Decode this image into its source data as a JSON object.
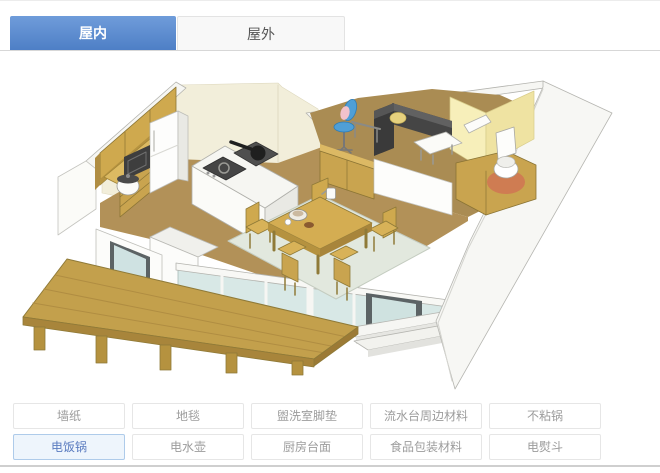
{
  "tabs": [
    {
      "label": "屋内",
      "active": true
    },
    {
      "label": "屋外",
      "active": false
    }
  ],
  "product_buttons": [
    {
      "label": "墙纸",
      "selected": false
    },
    {
      "label": "地毯",
      "selected": false
    },
    {
      "label": "盥洗室脚垫",
      "selected": false
    },
    {
      "label": "流水台周边材料",
      "selected": false
    },
    {
      "label": "不粘锅",
      "selected": false
    },
    {
      "label": "电饭锅",
      "selected": true
    },
    {
      "label": "电水壶",
      "selected": false
    },
    {
      "label": "厨房台面",
      "selected": false
    },
    {
      "label": "食品包装材料",
      "selected": false
    },
    {
      "label": "电熨斗",
      "selected": false
    }
  ],
  "colors": {
    "tab_active_bg": "#5b8bce",
    "tab_active_text": "#ffffff",
    "selected_button_border": "#aecbea",
    "selected_button_bg": "#eef5fc",
    "selected_button_text": "#5b7cc0",
    "wood": "#cda94e",
    "floor_brown": "#b29158",
    "wall_cream": "#f2eeda",
    "wall_yellow": "#f6edb0",
    "rug_gray_green": "#e2e8de",
    "sofa_dark": "#454545",
    "chair_blue": "#4f9fd6",
    "toilet_mat_orange": "#cf7c52",
    "glass_blue": "#d8e8e6"
  },
  "illustration": {
    "type": "isometric-home-interior-cutaway",
    "elements": [
      "kitchen-upper-cabinets",
      "refrigerator",
      "microwave",
      "rice-cooker",
      "kitchen-island",
      "gas-cooktop",
      "frying-pan",
      "dining-table",
      "dining-chairs",
      "tableware",
      "area-rug",
      "sofa",
      "sofa-cushion",
      "coffee-table",
      "desk",
      "desk-chair",
      "partition-cabinets",
      "bathroom-walls",
      "toilet",
      "toilet-mat",
      "wall-shelf",
      "sliding-glass-doors",
      "dark-framed-door",
      "entry-steps",
      "wood-deck",
      "deck-posts"
    ]
  }
}
